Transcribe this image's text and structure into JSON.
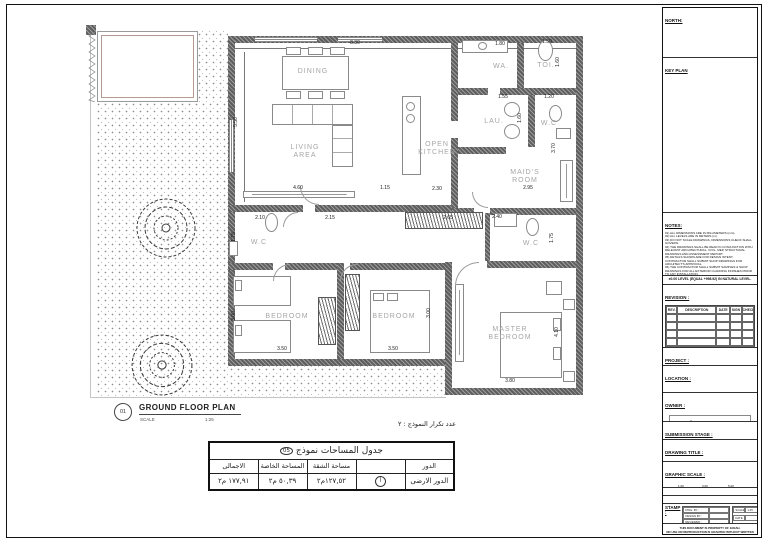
{
  "sheet": {
    "north_label": "NORTH:",
    "keyplan_label": "KEY PLAN",
    "notes_label": "NOTES:",
    "notes": [
      "01) ALL DIMENSIONS ARE IN MILLIMETERS (mm).",
      "02) ALL LEVELS ARE IN METERS (m).",
      "03) DO NOT SCALE DRAWINGS, DIMENSIONS CHECK SHALL GOVERN.",
      "04) THE DRAWINGS SHALL BE READ IN CONJUNCTION WITH RELEVANT ARCHITECTURAL, CIVIL, MEP, STRUCTURAL DRAWINGS AND ASSESSMENT REPORT.",
      "05) DETAILS SHOWN ARE FOR DESIGN INTENT, CONTRACTOR SHALL SUBMIT SHOP DRAWINGS FOR ARCHITECT'S APPROVAL.",
      "06) THE CONTRACTOR SHALL SUBMIT SAMPLES & SHOP DRAWINGS FOR ALL EXTERIOR CLADDING FINISHES PRIOR TO ANY INSTALLATION.",
      "07) ALL BLOCK WORKS CONTAIN GALVANIZED CORRUGATED ANCHOR FOR FIXATION INTO CONCRETE WALLS AND COLUMNS.",
      "08) ALL BLOCK WORKS CONTAIN HORIZONTAL METAL BLOCK REINFORCEMENTS (WIRE MESH).",
      "09) ALL BLOCK WORKS CONTAIN PLASTERING ACCESSORIES (WALL PLUG, PLASTER STOP, ARCHITRAVE BEAD, MOVEMENT BEAD, EXPANDED METAL LATH...).",
      "10) ALL BLOCK WALLS BETWEEN PIPE ZONES AND PIPE CORRIDOR SHALL BE FIRE INSULATED."
    ],
    "level_note": "±0.00 LEVEL (EQUAL +998.92) IN NATURAL LEVEL.",
    "revision_label": "REVISION :",
    "revision_headers": [
      "REV.",
      "DESCRIPTION",
      "DATE",
      "SIGN",
      "CHECK"
    ],
    "revision_empty_rows": 7,
    "project_label": "PROJECT :",
    "project_name": "EL-KHUZUMA RESIDENTIAL BUILDING",
    "location_label": "LOCATION :",
    "owner_label": "OWNER :",
    "owner_logo_ar": "جـادة",
    "owner_logo_en": "JADAH",
    "submission_label": "SUBMISSION STAGE :",
    "submission_value": "SHOP DRAWING",
    "drawing_title_label": "DRAWING TITLE :",
    "drawing_title_value": "نموذج رقم ٥",
    "graphic_scale_label": "GRAPHIC SCALE :",
    "scale_top_ticks": [
      "1.00",
      "3.00",
      "5.00"
    ],
    "scale_bottom_ticks": [
      "2.00",
      "4.00"
    ],
    "project_code_label": "PROJECT CODE :",
    "drawing_number_label": "DRAWING NUMBER :",
    "stamp_label": "STAMP :",
    "stamp_rows": [
      "DWG. BY :",
      "DESIGN BY :",
      "REVIEWED :",
      "APPROVED :"
    ],
    "stamp_scale_label": "SCALE",
    "stamp_scale_value": "1:25",
    "stamp_date_label": "DATE",
    "stamp_rev_label": "REV.",
    "footer_line1": "THIS DOCUMENT IS PROPERTY OF JADAH.",
    "footer_line2": "NO USE OR REPRODUCTION IS GRANTED WITHOUT WRITTEN PERMISSION"
  },
  "plan": {
    "number": "01",
    "title": "GROUND FLOOR PLAN",
    "scale_label": "SCALE",
    "scale_value": "1:25",
    "rooms": [
      {
        "label": "DINING",
        "x": 313,
        "y": 72
      },
      {
        "label": "LIVING\nAREA",
        "x": 305,
        "y": 152
      },
      {
        "label": "OPEN\nKITCHEN",
        "x": 437,
        "y": 149
      },
      {
        "label": "WA.",
        "x": 501,
        "y": 67
      },
      {
        "label": "TOI.",
        "x": 546,
        "y": 66
      },
      {
        "label": "LAU.",
        "x": 494,
        "y": 122
      },
      {
        "label": "W.C",
        "x": 549,
        "y": 124
      },
      {
        "label": "MAID'S\nROOM",
        "x": 525,
        "y": 177
      },
      {
        "label": "W.C",
        "x": 259,
        "y": 243
      },
      {
        "label": "W.C",
        "x": 531,
        "y": 244
      },
      {
        "label": "BEDROOM",
        "x": 287,
        "y": 317
      },
      {
        "label": "BEDROOM",
        "x": 394,
        "y": 317
      },
      {
        "label": "MASTER\nBEDROOM",
        "x": 510,
        "y": 334
      }
    ],
    "dims": [
      {
        "v": "8.30",
        "x": 355,
        "y": 43
      },
      {
        "v": "5.50",
        "x": 236,
        "y": 122,
        "vert": true
      },
      {
        "v": "1.80",
        "x": 500,
        "y": 44
      },
      {
        "v": "1.50",
        "x": 547,
        "y": 42
      },
      {
        "v": "1.60",
        "x": 558,
        "y": 62,
        "vert": true
      },
      {
        "v": "1.55",
        "x": 503,
        "y": 97
      },
      {
        "v": "1.20",
        "x": 549,
        "y": 97
      },
      {
        "v": "1.60",
        "x": 520,
        "y": 118,
        "vert": true
      },
      {
        "v": "3.70",
        "x": 554,
        "y": 148,
        "vert": true
      },
      {
        "v": "4.60",
        "x": 298,
        "y": 188
      },
      {
        "v": "1.15",
        "x": 385,
        "y": 188
      },
      {
        "v": "2.30",
        "x": 437,
        "y": 189
      },
      {
        "v": "2.95",
        "x": 528,
        "y": 188
      },
      {
        "v": "2.10",
        "x": 260,
        "y": 218
      },
      {
        "v": "2.15",
        "x": 330,
        "y": 218
      },
      {
        "v": "2.65",
        "x": 448,
        "y": 218
      },
      {
        "v": "2.40",
        "x": 497,
        "y": 217
      },
      {
        "v": "1.75",
        "x": 234,
        "y": 237,
        "vert": true
      },
      {
        "v": "1.75",
        "x": 552,
        "y": 238,
        "vert": true
      },
      {
        "v": "3.00",
        "x": 234,
        "y": 316,
        "vert": true
      },
      {
        "v": "3.00",
        "x": 429,
        "y": 313,
        "vert": true
      },
      {
        "v": "3.50",
        "x": 282,
        "y": 349
      },
      {
        "v": "3.50",
        "x": 393,
        "y": 349
      },
      {
        "v": "4.10",
        "x": 557,
        "y": 332,
        "vert": true
      },
      {
        "v": "3.80",
        "x": 510,
        "y": 381
      }
    ]
  },
  "area_table": {
    "repeat_note": "عدد تكرار النموذج : ٢",
    "title": "جدول المساحات نموذج",
    "title_badge": "05",
    "headers": [
      "الدور",
      "",
      "مساحة الشقة",
      "المساحة الخاصة",
      "الاجمالى"
    ],
    "row": {
      "floor": "الدور الارضى",
      "unit": "أ",
      "apartment_area": "١٢٧,٥٢م٢",
      "private_area": "٥٠,٣٩ م٢",
      "total_area": "١٧٧,٩١ م٢"
    }
  }
}
